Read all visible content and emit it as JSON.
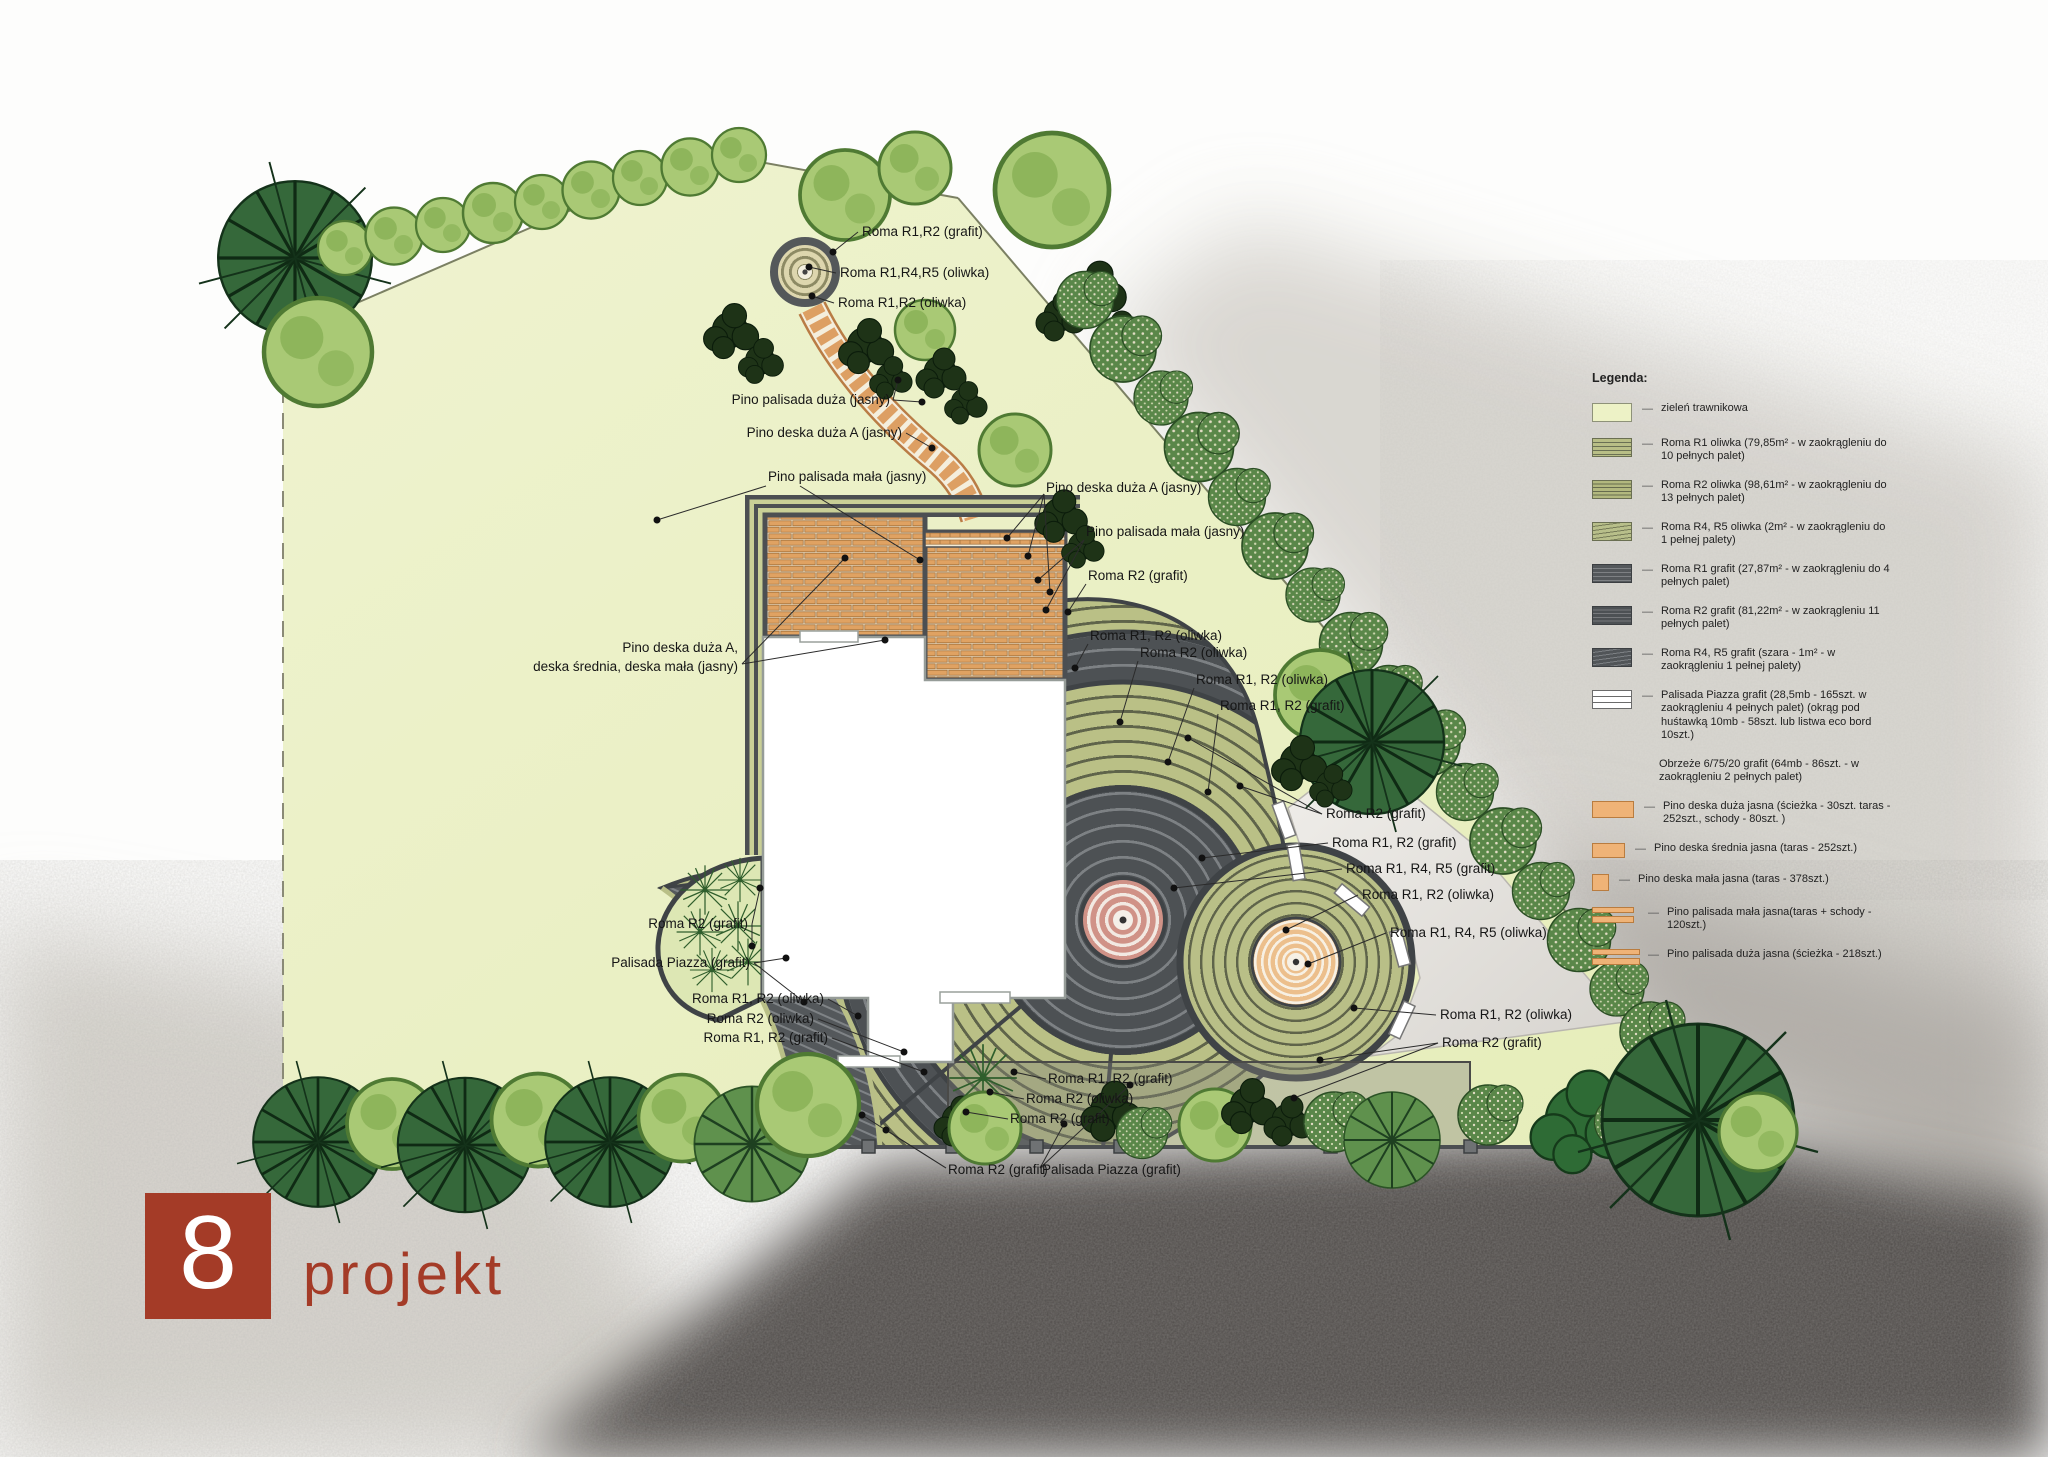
{
  "plan": {
    "labels": [
      {
        "text": "Roma R1,R2 (grafit)"
      },
      {
        "text": "Roma R1,R4,R5 (oliwka)"
      },
      {
        "text": "Roma R1,R2 (oliwka)"
      },
      {
        "text": "Pino palisada duża (jasny)"
      },
      {
        "text": "Pino deska duża A (jasny)"
      },
      {
        "text": "Pino palisada mała (jasny)"
      },
      {
        "text": "Pino deska duża A (jasny)"
      },
      {
        "text": "Pino palisada mała (jasny)"
      },
      {
        "text": "Roma R2 (grafit)"
      },
      {
        "text": "Roma R1, R2 (oliwka)"
      },
      {
        "text": "Roma R2 (oliwka)"
      },
      {
        "text": "Roma R1, R2 (oliwka)"
      },
      {
        "text": "Roma R1, R2 (grafit)"
      },
      {
        "text": "Roma R2 (grafit)"
      },
      {
        "text": "Roma R1, R2 (grafit)"
      },
      {
        "text": "Roma R1, R4, R5 (grafit)"
      },
      {
        "text": "Roma R1, R2 (oliwka)"
      },
      {
        "text": "Roma R1, R4, R5 (oliwka)"
      },
      {
        "text": "Roma R1, R2 (oliwka)"
      },
      {
        "text": "Roma R2 (grafit)"
      },
      {
        "text": "Roma R2 (grafit)"
      },
      {
        "text": "Palisada Piazza (grafit)"
      },
      {
        "text": "Roma R1, R2 (oliwka)"
      },
      {
        "text": "Roma R2 (oliwka)"
      },
      {
        "text": "Roma R1, R2 (grafit)"
      },
      {
        "text": "Roma R1, R2 (grafit)"
      },
      {
        "text": "Roma R2 (oliwka)"
      },
      {
        "text": "Roma R2 (grafit)"
      },
      {
        "text": "Roma R2 (grafit)"
      },
      {
        "text": "Palisada Piazza (grafit)"
      },
      {
        "text": "Pino deska duża A,"
      },
      {
        "text": "deska średnia, deska mała (jasny)"
      }
    ]
  },
  "legend": {
    "title": "Legenda:",
    "dash": "—",
    "items": [
      {
        "text": "zieleń trawnikowa"
      },
      {
        "text": "Roma R1 oliwka (79,85m² - w zaokrągleniu do 10 pełnych palet)"
      },
      {
        "text": "Roma R2 oliwka (98,61m² - w zaokrągleniu do 13 pełnych palet)"
      },
      {
        "text": "Roma R4, R5 oliwka (2m² - w zaokrągleniu do 1 pełnej palety)"
      },
      {
        "text": "Roma R1 grafit (27,87m² - w zaokrągleniu do 4 pełnych palet)"
      },
      {
        "text": "Roma R2 grafit (81,22m² - w zaokrągleniu 11 pełnych palet)"
      },
      {
        "text": "Roma R4, R5 grafit (szara - 1m² - w zaokrągleniu 1 pełnej palety)"
      },
      {
        "text": "Palisada Piazza grafit (28,5mb - 165szt. w zaokrągleniu 4 pełnych palet) (okrąg pod huśtawką 10mb - 58szt. lub listwa eco bord 10szt.)"
      },
      {
        "text": "Obrzeże 6/75/20 grafit (64mb - 86szt. - w zaokrągleniu 2 pełnych palet)"
      },
      {
        "text": "Pino deska duża jasna (ścieżka - 30szt. taras - 252szt., schody - 80szt. )"
      },
      {
        "text": "Pino deska średnia jasna (taras - 252szt.)"
      },
      {
        "text": "Pino deska mała jasna (taras - 378szt.)"
      },
      {
        "text": "Pino palisada mała jasna(taras + schody - 120szt.)"
      },
      {
        "text": "Pino palisada duża jasna (ścieżka - 218szt.)"
      }
    ]
  },
  "logo": {
    "number": "8",
    "name": "projekt"
  },
  "colors": {
    "lawn": "#EAF0C5",
    "olive_paver": "#B8BE86",
    "graphite_paver": "#4D5154",
    "deck_wood": "#E0A262",
    "center_pink": "#D09287",
    "center_peach": "#ECBF8C",
    "logo_red": "#A43B27"
  }
}
